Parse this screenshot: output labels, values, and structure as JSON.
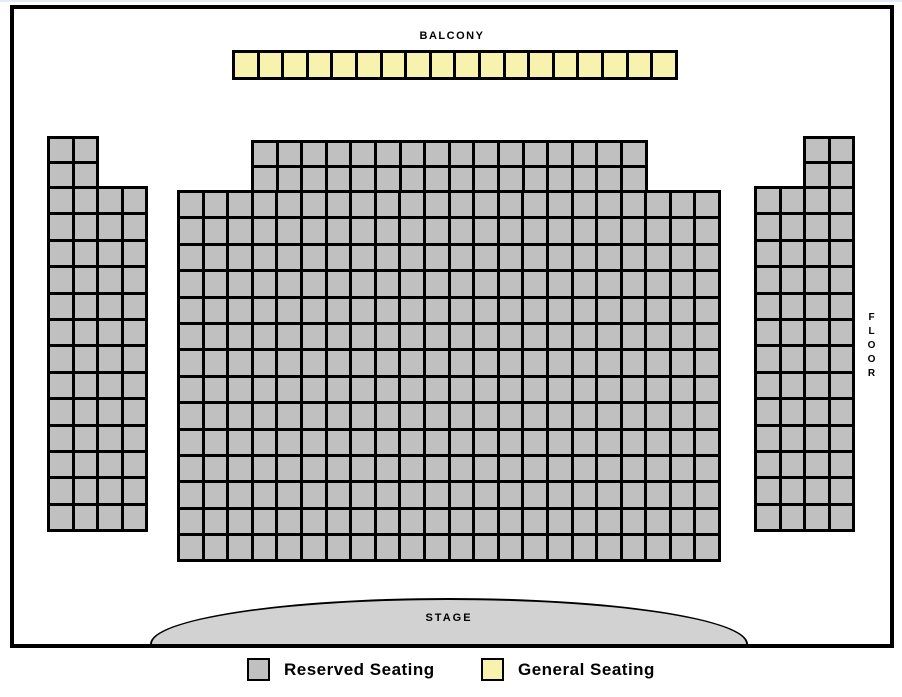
{
  "labels": {
    "balcony": "BALCONY",
    "stage": "STAGE",
    "floor_vertical": "FLOOR"
  },
  "legend": {
    "items": [
      {
        "label": "Reserved Seating",
        "swatch_color": "#c0c0c0"
      },
      {
        "label": "General Seating",
        "swatch_color": "#f7f3ae"
      }
    ]
  },
  "colors": {
    "reserved_seat": "#c0c0c0",
    "general_seat": "#f7f3ae",
    "stage_fill": "#d2d2d2",
    "outline": "#000000"
  },
  "sections": {
    "balcony": {
      "name": "Balcony",
      "seat_type": "general",
      "grids": [
        {
          "rows": 1,
          "cols": 18
        }
      ],
      "seat_count": 18
    },
    "floor_left": {
      "name": "Floor left wing",
      "seat_type": "reserved",
      "grids": [
        {
          "rows": 2,
          "cols": 2
        },
        {
          "rows": 13,
          "cols": 4
        }
      ],
      "seat_count": 56
    },
    "floor_center": {
      "name": "Floor center",
      "seat_type": "reserved",
      "grids": [
        {
          "rows": 2,
          "cols": 16
        },
        {
          "rows": 14,
          "cols": 22
        }
      ],
      "seat_count": 340
    },
    "floor_right": {
      "name": "Floor right wing",
      "seat_type": "reserved",
      "grids": [
        {
          "rows": 2,
          "cols": 2
        },
        {
          "rows": 13,
          "cols": 4
        }
      ],
      "seat_count": 56
    }
  },
  "totals": {
    "reserved_seats": 452,
    "general_seats": 18,
    "total_seats": 470
  }
}
